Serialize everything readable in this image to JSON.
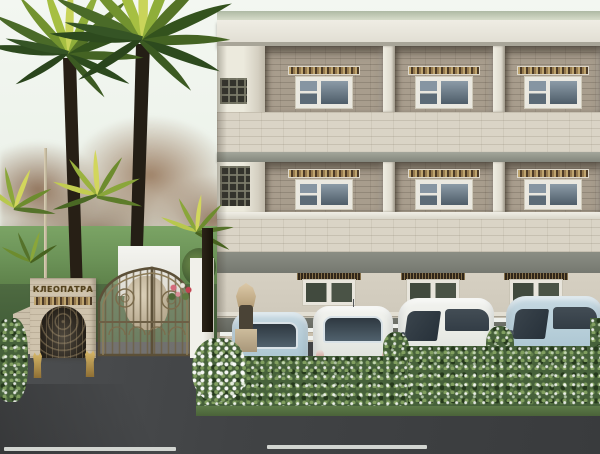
{
  "meta": {
    "type": "3d-architectural-rendering",
    "subject": "Street facade of the Cleopatra residential complex with entrance gates, palm trees, hedge-screened parking and asphalt road"
  },
  "signage": {
    "gate_sign_text": "КЛЕОПАТРА"
  },
  "building": {
    "floors_visible": 3,
    "window_bays_per_floor": 3,
    "facade": "beige stone with recessed brick window bays, ornamental mosaic lintels, white pillars, grey string courses and dark plinth",
    "roof": "flat white slab with pale green coping"
  },
  "entrance": {
    "pedestrian_gate": "stone arch with bronze openwork door flanked by golden cat statues",
    "driveway_gate": "double-leaf arched wrought-iron gate",
    "right_pillar": "white masonry gate pillar",
    "statue": "Egyptian sphinx figure beside the building corner"
  },
  "vegetation": {
    "palms": 2,
    "palm_shrubs": 4,
    "background_trees": "autumn deciduous trees",
    "lawn": "green lawn",
    "hedge": "flowering evergreen hedge screening the parking"
  },
  "vehicles": [
    {
      "order": 1,
      "body": "hatchback",
      "color": "light blue",
      "view": "rear"
    },
    {
      "order": 2,
      "body": "hatchback",
      "color": "white",
      "view": "rear"
    },
    {
      "order": 3,
      "body": "minivan",
      "color": "white",
      "view": "front-three-quarter"
    },
    {
      "order": 4,
      "body": "minivan",
      "color": "light blue",
      "view": "front-three-quarter"
    }
  ],
  "road": {
    "surface": "dark asphalt",
    "markings": [
      "white lane dash left",
      "white lane dash center"
    ]
  },
  "palette": {
    "sky": "#eef4ee",
    "facade_light": "#d8d2c4",
    "bay_brick": "#a89d8d",
    "white_trim": "#edebe2",
    "string_course_grey": "#83867c",
    "plinth_grey": "#6b6e66",
    "mosaic_lintel": "#6d5b43",
    "window_glass": "#5c6b77",
    "palm_frond_dark": "#2d4a1e",
    "palm_frond_light": "#c9d45a",
    "palm_trunk": "#241e15",
    "autumn_foliage": "#8d6f56",
    "lawn": "#6b9257",
    "hedge": "#46613a",
    "gate_bronze": "#6d5f45",
    "stone_arch": "#cfc3ad",
    "asphalt": "#3f4143",
    "road_marking": "#d2d5d1",
    "car_light_blue": "#b7cdd8",
    "car_white": "#eceee9",
    "statue_gold": "#c4a45c"
  }
}
